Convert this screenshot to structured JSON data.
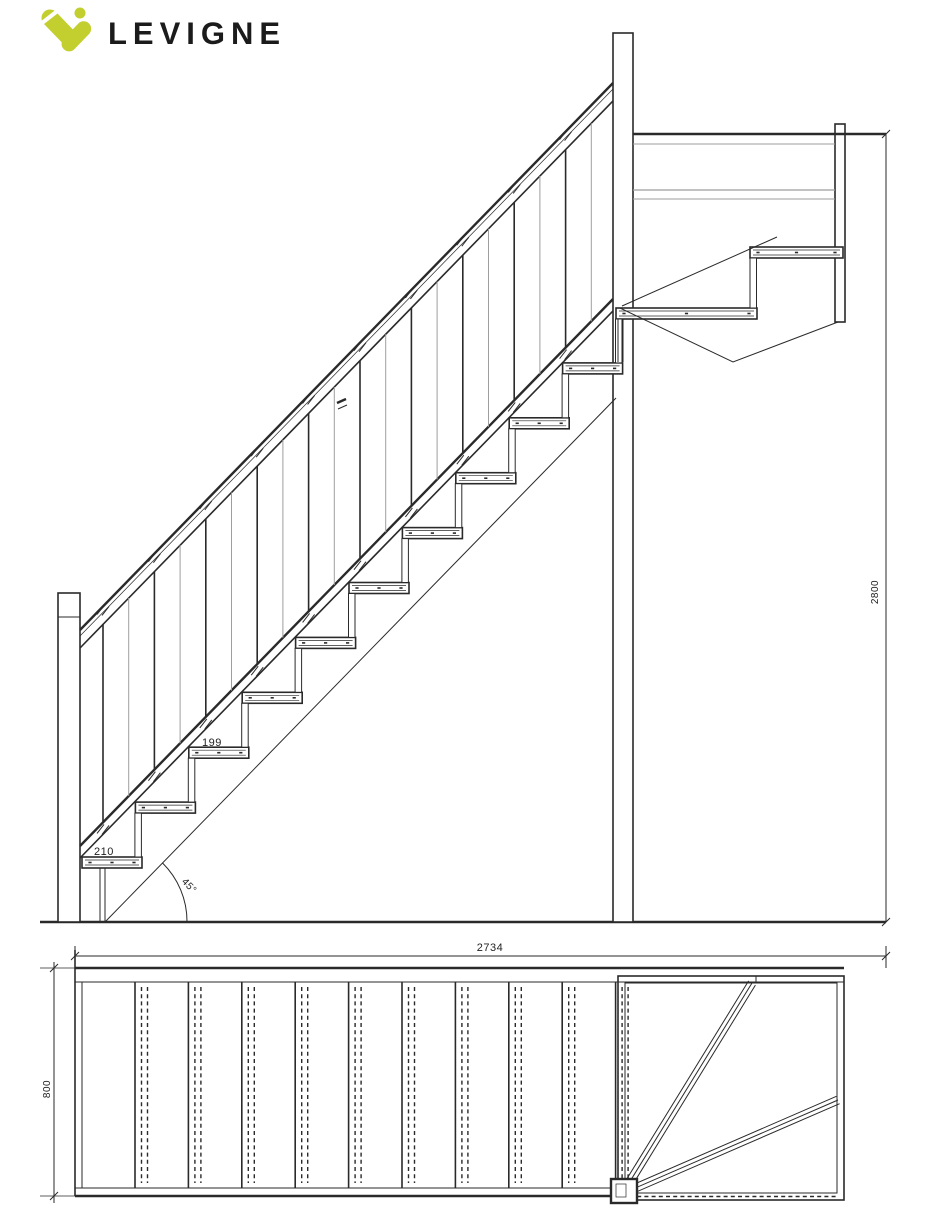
{
  "brand": {
    "name": "LEVIGNE",
    "logo_icon": "levigne-check-mark",
    "logo_color": "#c3cf2e",
    "text_color": "#1b1b1b"
  },
  "drawing": {
    "type": "staircase technical drawing",
    "line_color": "#2a2a2a",
    "light_line_color": "#9e9e9e",
    "background": "#ffffff"
  },
  "elevation_view": {
    "description": "side elevation of quarter-turn staircase with balustrade and top landing",
    "dimensions": {
      "tread_going_label": "210",
      "riser_height_label": "199",
      "stair_angle_label": "45°",
      "floor_to_floor_label": "2800"
    }
  },
  "plan_view": {
    "description": "top plan of straight flight with two winder treads on landing",
    "dimensions": {
      "total_run_label": "2734",
      "stair_width_label": "800"
    }
  }
}
